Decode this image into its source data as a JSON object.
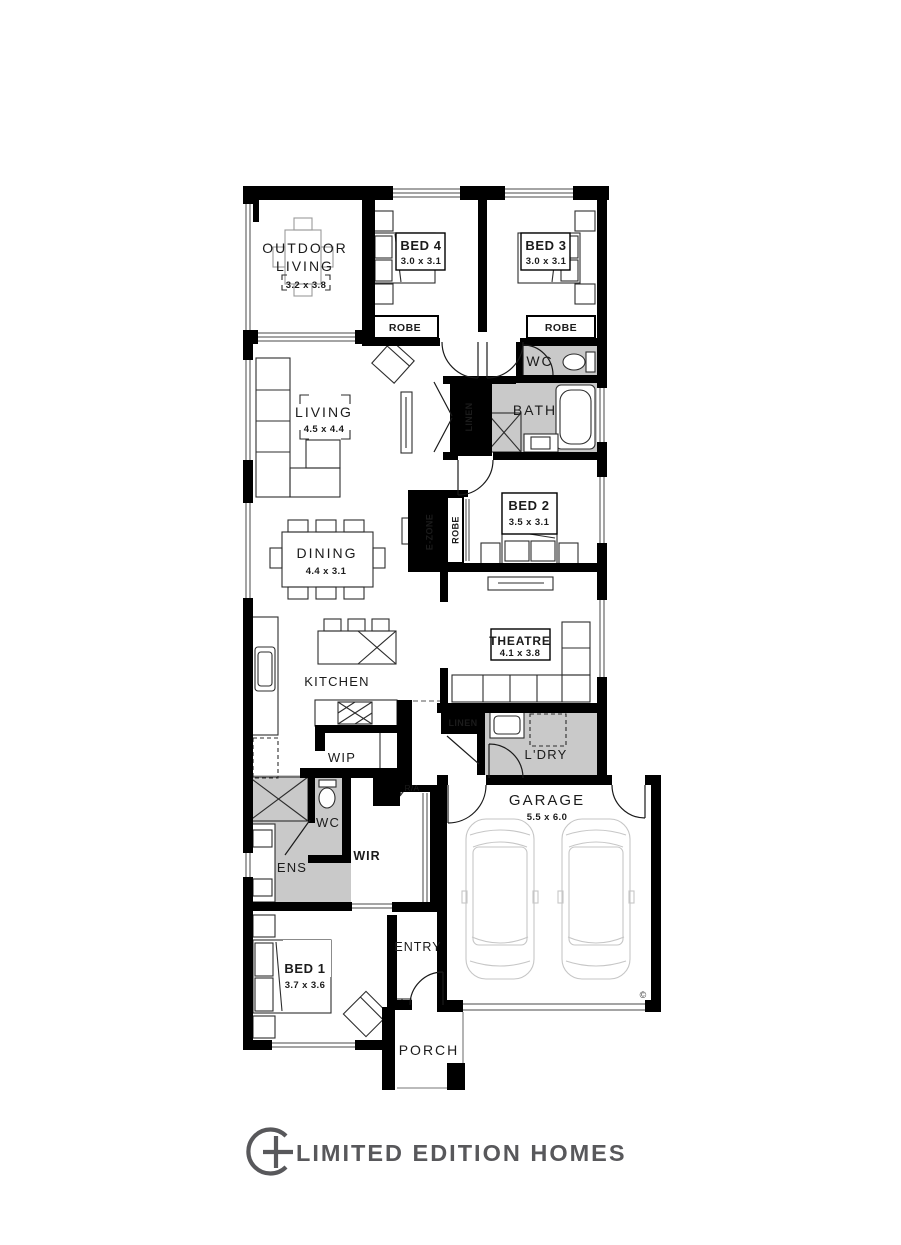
{
  "brand": {
    "name": "LIMITED EDITION HOMES",
    "icon": "circle-plus-icon"
  },
  "colors": {
    "wall": "#000000",
    "wet_area": "#c9c9c9",
    "logo_gray": "#58585b"
  },
  "rooms": {
    "outdoor_living": {
      "line1": "OUTDOOR",
      "line2": "LIVING",
      "dims": "3.2 x 3.8"
    },
    "bed4": {
      "name": "BED 4",
      "dims": "3.0 x 3.1"
    },
    "bed3": {
      "name": "BED 3",
      "dims": "3.0 x 3.1"
    },
    "robe_bed4": {
      "name": "ROBE"
    },
    "robe_bed3": {
      "name": "ROBE"
    },
    "wc_rear": {
      "name": "WC"
    },
    "living": {
      "name": "LIVING",
      "dims": "4.5 x 4.4"
    },
    "linen_bath": {
      "name": "LINEN"
    },
    "bath": {
      "name": "BATH"
    },
    "bed2": {
      "name": "BED 2",
      "dims": "3.5 x 3.1"
    },
    "ezone": {
      "name": "E-ZONE"
    },
    "robe_bed2": {
      "name": "ROBE"
    },
    "dining": {
      "name": "DINING",
      "dims": "4.4 x 3.1"
    },
    "kitchen": {
      "name": "KITCHEN"
    },
    "theatre": {
      "name": "THEATRE",
      "dims": "4.1 x 3.8"
    },
    "linen_hall": {
      "name": "LINEN"
    },
    "laundry": {
      "name": "L'DRY"
    },
    "wip": {
      "name": "WIP"
    },
    "garage": {
      "name": "GARAGE",
      "dims": "5.5 x 6.0"
    },
    "ens": {
      "name": "ENS"
    },
    "wc_ens": {
      "name": "WC"
    },
    "wir": {
      "name": "WIR"
    },
    "entry": {
      "name": "ENTRY"
    },
    "bed1": {
      "name": "BED 1",
      "dims": "3.7 x 3.6"
    },
    "porch": {
      "name": "PORCH"
    }
  },
  "annotations": {
    "return_air": "R/A",
    "copyright": "©"
  }
}
